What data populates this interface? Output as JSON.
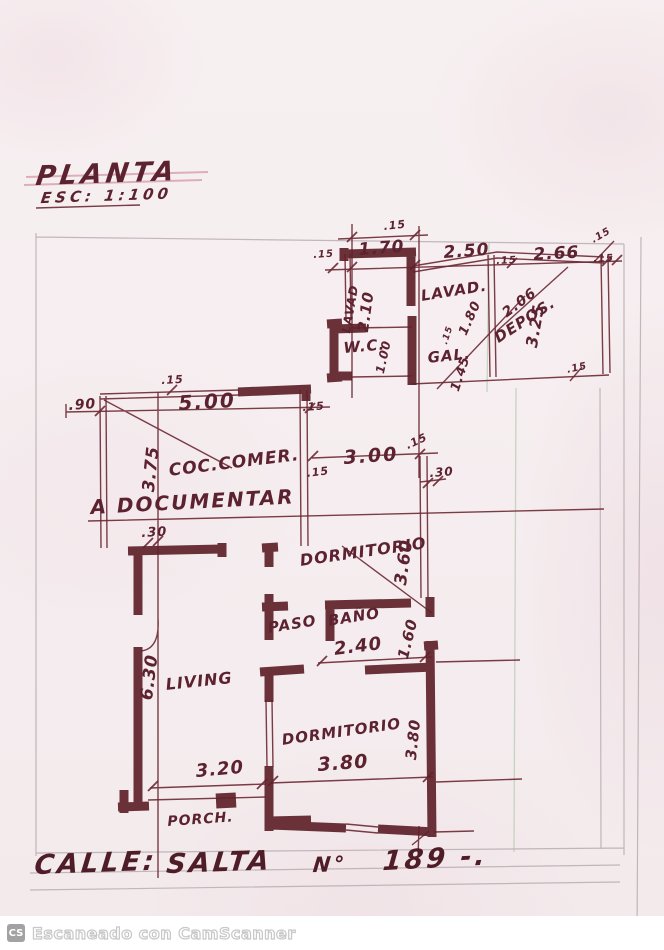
{
  "plan": {
    "title": "PLANTA",
    "scale": "ESC: 1:100",
    "note": "A DOCUMENTAR",
    "rooms": {
      "coc_comer": "COC.COMER.",
      "living": "LIVING",
      "dormitorio_1": "DORMITORIO",
      "dormitorio_2": "DORMITORIO",
      "paso": "PASO",
      "bano": "BAÑO",
      "wc": "W.C.",
      "gal": "GAL.",
      "lavad": "LAVAD.",
      "lavad_side": "LAVAD",
      "depos": "DEPOS.",
      "porch": "PORCH."
    },
    "dimensions": {
      "d015": ".15",
      "d030": ".30",
      "d090": ".90",
      "d100": "1.00",
      "d145": "1.45",
      "d160": "1.60",
      "d170": "1.70",
      "d180": "1.80",
      "d206": "2.06",
      "d210": "2.10",
      "d240": "2.40",
      "d250": "2.50",
      "d266": "2.66",
      "d300": "3.00",
      "d320": "3.20",
      "d325": "3.25",
      "d360": "3.60",
      "d375": "3.75",
      "d380": "3.80",
      "d500": "5.00",
      "d630": "6.30"
    },
    "address": {
      "label": "CALLE:",
      "street": "SALTA",
      "number_sign": "N°",
      "number": "189 -."
    }
  },
  "footer": {
    "badge": "CS",
    "text": "Escaneado con CamScanner"
  },
  "colors": {
    "ink": "#6d2833",
    "wall": "#5e2129",
    "paper": "#f6eef0",
    "pencil": "#b0a4aa"
  }
}
